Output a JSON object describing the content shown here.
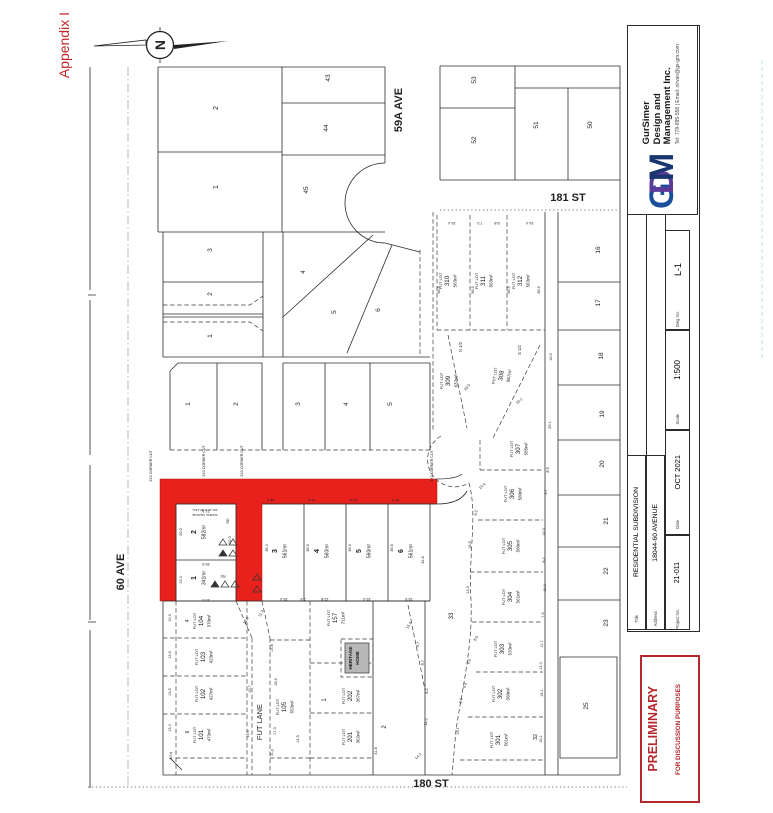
{
  "appendix": "Appendix I",
  "logo": {
    "m1": "G",
    "m2": "D",
    "m3": "M",
    "line1": "GurSimer",
    "line2": "Design and",
    "line3": "Management Inc.",
    "contact": "Tel: 778-895-558 | Email: nirvair@gs-gm.com"
  },
  "title_block": {
    "title_label": "Title",
    "title": "RESIDENTIAL SUBDIVISION",
    "address_label": "Address",
    "address": "18044-60 AVENUE",
    "project_label": "Project No.",
    "project": "21-011",
    "date_label": "Date",
    "date": "OCT 2021",
    "scale_label": "Scale",
    "scale": "1:500",
    "dwg_label": "Dwg No.",
    "dwg": "L-1"
  },
  "stamp": {
    "line1": "PRELIMINARY",
    "line2": "FOR DISCUSSION PURPOSES"
  },
  "streets": {
    "ave59a": "59A AVE",
    "st181": "181 ST",
    "st180": "180 ST",
    "ave60": "60 AVE",
    "fut_lane": "FUT LANE"
  },
  "north": {
    "letter": "N"
  },
  "annotations": {
    "fut_lot": "FUT LOT",
    "corner_cut": "3X3 CORNER CUT",
    "n_half": "N 1/2",
    "s_half": "S 1/2",
    "heritage1": "HERITAGE",
    "heritage2": "HOME",
    "zoning1": "(RF-13 to RF-13C)",
    "zoning2": "ZONING CHANGE",
    "road_mark1": "RD",
    "road_mark2": "RD"
  },
  "highlight": {
    "n1": {
      "no": "1",
      "area": "341m²"
    },
    "n2": {
      "no": "2",
      "area": "582m²"
    },
    "n3": {
      "no": "3",
      "area": "561m²"
    },
    "n4": {
      "no": "4",
      "area": "560m²"
    },
    "n5": {
      "no": "5",
      "area": "560m²"
    },
    "n6": {
      "no": "6",
      "area": "561m²"
    }
  },
  "future_lots": {
    "f101": {
      "no": "101",
      "area": "473m²"
    },
    "f102": {
      "no": "102",
      "area": "427m²"
    },
    "f103": {
      "no": "103",
      "area": "423m²"
    },
    "f104": {
      "no": "104",
      "area": "370m²"
    },
    "f105": {
      "no": "105",
      "area": "553m²"
    },
    "f157": {
      "no": "157",
      "area": "711m²"
    },
    "f201": {
      "no": "201",
      "area": "362m²"
    },
    "f202": {
      "no": "202",
      "area": "367m²"
    },
    "f301": {
      "no": "301",
      "area": "561m²"
    },
    "f302": {
      "no": "302",
      "area": "560m²"
    },
    "f303": {
      "no": "303",
      "area": "533m²"
    },
    "f304": {
      "no": "304",
      "area": "561m²"
    },
    "f305": {
      "no": "305",
      "area": "560m²"
    },
    "f306": {
      "no": "306",
      "area": "560m²"
    },
    "f307": {
      "no": "307",
      "area": "585m²"
    },
    "f308": {
      "no": "308",
      "area": "867m²"
    },
    "f309": {
      "no": "309",
      "area": "637m²"
    },
    "f310": {
      "no": "310",
      "area": "563m²"
    },
    "f311": {
      "no": "311",
      "area": "563m²"
    },
    "f312": {
      "no": "312",
      "area": "563m²"
    }
  },
  "existing": {
    "tl2": "2",
    "tl1": "1",
    "t43": "43",
    "t44": "44",
    "t45": "45",
    "tr53": "53",
    "tr52": "52",
    "tr51": "51",
    "tr50": "50",
    "ml3": "3",
    "ml2": "2",
    "ml1": "1",
    "mr4": "4",
    "mr5": "5",
    "mr6": "6",
    "r1": "1",
    "r2": "2",
    "r3": "3",
    "r4": "4",
    "r5": "5",
    "e16": "16",
    "e17": "17",
    "e18": "18",
    "e19": "19",
    "e20": "20",
    "e21": "21",
    "e22": "22",
    "e23": "23",
    "e25": "25",
    "e32": "32",
    "e33": "33",
    "b4": "4",
    "b6": "6",
    "b1": "1",
    "b2": "2"
  },
  "dims": [
    "21.5",
    "20.0",
    "22.0",
    "13.4",
    "25.5",
    "25.5",
    "14.4",
    "15.4",
    "15.4",
    "15.4",
    "35.4",
    "36.5",
    "36.5",
    "36.5",
    "32.8",
    "15.4",
    "2.4",
    "12.8",
    "15.4",
    "15.5",
    "10.3",
    "13.5",
    "13.5",
    "13.4",
    "12.0",
    "11.3",
    "13.8",
    "10.7",
    "18.9",
    "14.4",
    "17.3",
    "14.5",
    "11.0",
    "15.4",
    "8.7",
    "6.7",
    "8.2",
    "11.3",
    "14.2",
    "31.8",
    "15.4",
    "7.3",
    "8.8",
    "15.4",
    "36.5",
    "36.5",
    "36.5",
    "36.5",
    "43.5",
    "16.0",
    "16.1",
    "25.1",
    "8.5",
    "4.7",
    "10.4",
    "6.2",
    "18.5",
    "13.3",
    "10.3",
    "8.2",
    "11.0",
    "7.4",
    "8.0",
    "8.5",
    "9.3",
    "5.6",
    "13.1",
    "11.7",
    "14.4",
    "16.1",
    "16.1",
    "10.4"
  ]
}
